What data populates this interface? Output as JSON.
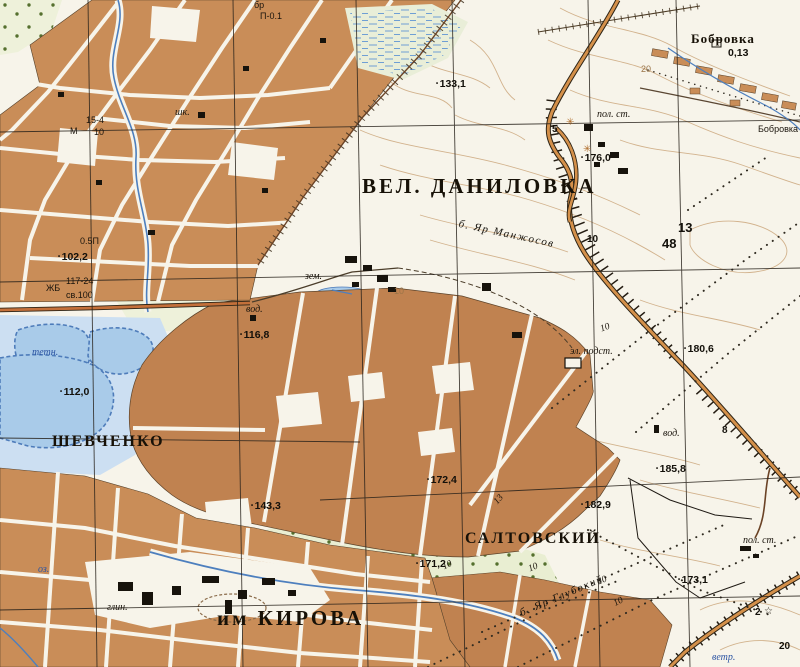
{
  "map": {
    "type": "soviet-topographic-map",
    "colors": {
      "paper": "#f7f4ea",
      "urban_block": "#c98d58",
      "orchard_field": "#c08250",
      "field_green": "#eef1da",
      "orchard_green": "#e9eed2",
      "pond_fill": "#a9cbe9",
      "floodplain": "#ccdff2",
      "water_line": "#4d7fbe",
      "contour": "#c69d6e",
      "road_fill": "#c4703a",
      "road_casing": "#2d2416",
      "grid_line": "#27211a",
      "label_black": "#171107",
      "label_blue": "#2d55a3"
    },
    "labels": {
      "settlements": [
        {
          "text": "ВЕЛ. ДАНИЛОВКА",
          "x": 362,
          "y": 174,
          "cls": "town-lg",
          "name": "label-vel-danilovka"
        },
        {
          "text": "им КИРОВА",
          "x": 217,
          "y": 606,
          "cls": "town-lg",
          "name": "label-im-kirova"
        },
        {
          "text": "ШЕВЧЕНКО",
          "x": 52,
          "y": 433,
          "cls": "town-md",
          "name": "label-shevchenko"
        },
        {
          "text": "САЛТОВСКИЙ",
          "x": 465,
          "y": 530,
          "cls": "town-md",
          "name": "label-saltovskiy"
        },
        {
          "text": "Бобровка",
          "x": 691,
          "y": 31,
          "cls": "town-sm",
          "name": "label-bobrovka"
        },
        {
          "text": "Бобровка",
          "x": 758,
          "y": 124,
          "cls": "tech",
          "name": "label-bobrovka-stream"
        }
      ],
      "elevations": [
        {
          "text": "133,1",
          "x": 436,
          "y": 78,
          "name": "elevation-133-1"
        },
        {
          "text": "176,0",
          "x": 581,
          "y": 152,
          "name": "elevation-176-0"
        },
        {
          "text": "102,2",
          "x": 58,
          "y": 251,
          "name": "elevation-102-2"
        },
        {
          "text": "116,8",
          "x": 240,
          "y": 329,
          "name": "elevation-116-8"
        },
        {
          "text": "112,0",
          "x": 60,
          "y": 386,
          "name": "elevation-112-0"
        },
        {
          "text": "143,3",
          "x": 251,
          "y": 500,
          "name": "elevation-143-3"
        },
        {
          "text": "172,4",
          "x": 427,
          "y": 474,
          "name": "elevation-172-4"
        },
        {
          "text": "171,2",
          "x": 416,
          "y": 558,
          "name": "elevation-171-2"
        },
        {
          "text": "182,9",
          "x": 581,
          "y": 499,
          "name": "elevation-182-9"
        },
        {
          "text": "185,8",
          "x": 656,
          "y": 463,
          "name": "elevation-185-8"
        },
        {
          "text": "180,6",
          "x": 684,
          "y": 343,
          "name": "elevation-180-6"
        },
        {
          "text": "173,1",
          "x": 678,
          "y": 574,
          "name": "elevation-173-1"
        },
        {
          "text": "0,13",
          "x": 728,
          "y": 47,
          "cls": "elev nodot",
          "name": "depth-0-13"
        }
      ],
      "notes": [
        {
          "text": "пол. ст.",
          "x": 597,
          "y": 109,
          "name": "note-pol-st-north"
        },
        {
          "text": "пол. ст.",
          "x": 743,
          "y": 535,
          "name": "note-pol-st-southeast"
        },
        {
          "text": "эл. подст.",
          "x": 570,
          "y": 346,
          "name": "note-el-podst"
        },
        {
          "text": "зем.",
          "x": 305,
          "y": 271,
          "name": "note-zem"
        },
        {
          "text": "вод.",
          "x": 246,
          "y": 304,
          "name": "note-vod-west"
        },
        {
          "text": "вод.",
          "x": 663,
          "y": 428,
          "name": "note-vod-east"
        },
        {
          "text": "шк.",
          "x": 175,
          "y": 107,
          "name": "note-shkola"
        },
        {
          "text": "глин.",
          "x": 107,
          "y": 602,
          "name": "note-glin"
        },
        {
          "text": "бр",
          "x": 254,
          "y": 0,
          "cls": "tech",
          "name": "note-brod"
        },
        {
          "text": "П-0.1",
          "x": 260,
          "y": 11,
          "cls": "tech",
          "name": "note-brod-value"
        },
        {
          "text": "15-4",
          "x": 86,
          "y": 115,
          "cls": "tech",
          "name": "bridge-15-4"
        },
        {
          "text": "М",
          "x": 70,
          "y": 126,
          "cls": "tech",
          "name": "bridge-material"
        },
        {
          "text": "10",
          "x": 94,
          "y": 127,
          "cls": "tech",
          "name": "bridge-load"
        },
        {
          "text": "0.5П",
          "x": 80,
          "y": 236,
          "cls": "tech",
          "name": "note-05p"
        },
        {
          "text": "ЖБ",
          "x": 46,
          "y": 283,
          "cls": "tech",
          "name": "bridge-zhb"
        },
        {
          "text": "117-24",
          "x": 66,
          "y": 276,
          "cls": "tech",
          "name": "bridge-117-24"
        },
        {
          "text": "св.100",
          "x": 66,
          "y": 290,
          "cls": "tech",
          "name": "bridge-sv-100"
        }
      ],
      "notes_blue": [
        {
          "text": "тетн.",
          "x": 32,
          "y": 347,
          "name": "note-blue-ponds"
        },
        {
          "text": "оз.",
          "x": 38,
          "y": 564,
          "name": "note-blue-ozero"
        },
        {
          "text": "ветр.",
          "x": 712,
          "y": 652,
          "name": "note-blue-vetr"
        }
      ],
      "ravines": [
        {
          "text": "б. Яр Манжосов",
          "x": 460,
          "y": 218,
          "rot": 12,
          "name": "ravine-yar-manzhosov"
        },
        {
          "text": "б. Яр Глубокий",
          "x": 518,
          "y": 608,
          "rot": -23,
          "name": "ravine-yar-glubokiy"
        }
      ],
      "road_numbers": [
        {
          "text": "10",
          "x": 587,
          "y": 234,
          "name": "road-number-10"
        },
        {
          "text": "5",
          "x": 552,
          "y": 124,
          "name": "road-number-5"
        },
        {
          "text": "8",
          "x": 722,
          "y": 425,
          "name": "road-number-8"
        },
        {
          "text": "2",
          "x": 755,
          "y": 607,
          "name": "road-number-2"
        },
        {
          "text": "20",
          "x": 779,
          "y": 641,
          "name": "road-number-20"
        }
      ],
      "grid_numbers": [
        {
          "text": "13",
          "x": 678,
          "y": 220,
          "name": "grid-number-13"
        },
        {
          "text": "48",
          "x": 662,
          "y": 236,
          "name": "grid-number-48"
        }
      ],
      "contour_numbers": [
        {
          "text": "20",
          "x": 641,
          "y": 64,
          "name": "contour-number-20"
        },
        {
          "text": "10",
          "x": 394,
          "y": 286,
          "name": "contour-number-10"
        }
      ],
      "treeline_numbers": [
        {
          "text": "10",
          "x": 599,
          "y": 325,
          "rot": -20,
          "name": "treeline-10-a"
        },
        {
          "text": "13",
          "x": 492,
          "y": 500,
          "rot": -48,
          "name": "treeline-13"
        },
        {
          "text": "10",
          "x": 441,
          "y": 563,
          "rot": -25,
          "name": "treeline-10-b"
        },
        {
          "text": "10",
          "x": 527,
          "y": 565,
          "rot": -22,
          "name": "treeline-10-c"
        },
        {
          "text": "10",
          "x": 596,
          "y": 578,
          "rot": -22,
          "name": "treeline-10-d"
        },
        {
          "text": "10",
          "x": 612,
          "y": 600,
          "rot": -28,
          "name": "treeline-10-e"
        }
      ],
      "symbols": [
        {
          "text": "✳",
          "x": 566,
          "y": 117,
          "cls": "sym",
          "name": "windmill-icon-a"
        },
        {
          "text": "✳",
          "x": 583,
          "y": 144,
          "cls": "sym",
          "name": "windmill-icon-b"
        },
        {
          "text": "☆",
          "x": 764,
          "y": 606,
          "cls": "sym-dark",
          "name": "star-icon"
        }
      ]
    }
  }
}
